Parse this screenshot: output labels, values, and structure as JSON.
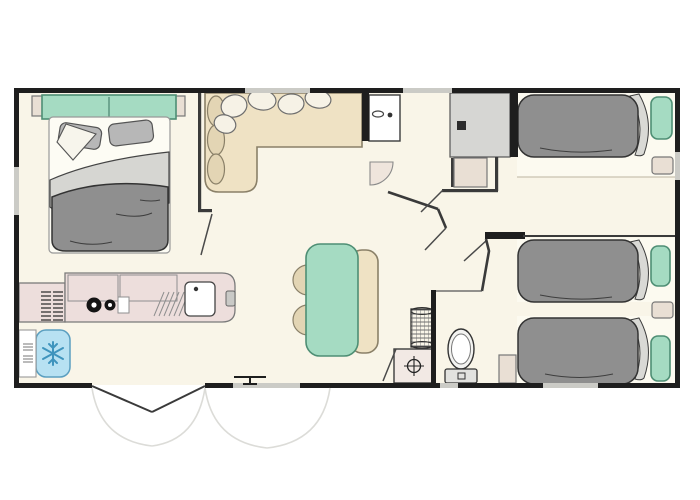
{
  "colors": {
    "floor": "#f9f5e8",
    "wall": "#1e1e1e",
    "innerWall": "#3a3a3a",
    "window": "#cbcbc6",
    "teal": "#a5dbc2",
    "tealDark": "#4e8e74",
    "sofa": "#efe2c4",
    "sofaStroke": "#8a8068",
    "cushion": "#e3d5b4",
    "pillowWhite": "#f6f2e6",
    "duvet": "#8f8f8f",
    "sheet": "#d6d6d2",
    "mattress": "#fdfcf4",
    "pillowGray": "#b7b7b7",
    "counter": "#eddedc",
    "counterStroke": "#7a7a7a",
    "fridge": "#b7e1f2",
    "fridgeStroke": "#5b9fc0",
    "snowflake": "#3f94bd",
    "wardrobe": "#d6d6d3",
    "shelf": "#e9dfd4",
    "fixture": "#f4f1ea",
    "fixtureStroke": "#3c3c3c",
    "arc": "#dcdcd8",
    "leaf": "#4a4a4a",
    "bedBase": "#fcfaf0"
  },
  "rooms": {
    "master_bedroom": "master bedroom with double bed",
    "living": "living area with corner sofa",
    "kitchen": "kitchenette with hob, sink, fridge",
    "dining": "dining area with table, bench and chairs",
    "bathroom": "shower room with washbasin and wardrobe",
    "wc": "wc with toilet",
    "hallway": "central hallway",
    "bedroom2": "twin bedroom (top single bed)",
    "bedroom3": "twin bedroom (two single beds)",
    "entrance": "double entrance door with swing arcs"
  },
  "furniture": [
    "double-bed",
    "teal-headboard",
    "gray-pillows",
    "gray-duvet",
    "corner-sofa",
    "sofa-back-cushions",
    "sofa-throw-pillows",
    "wardrobe",
    "washbasin",
    "door-swing",
    "shower-tray",
    "laundry-basket",
    "toilet",
    "kitchen-counter",
    "two-burner-hob",
    "kitchen-sink",
    "drainer",
    "wall-heater",
    "fridge-freezer",
    "microwave-cabinet",
    "dining-table",
    "bench-seat",
    "two-chairs",
    "single-bed-1",
    "single-bed-2",
    "single-bed-3",
    "teal-bed-pillows",
    "bedside-shelves",
    "corner-cabinet",
    "entrance-double-door",
    "windows"
  ]
}
